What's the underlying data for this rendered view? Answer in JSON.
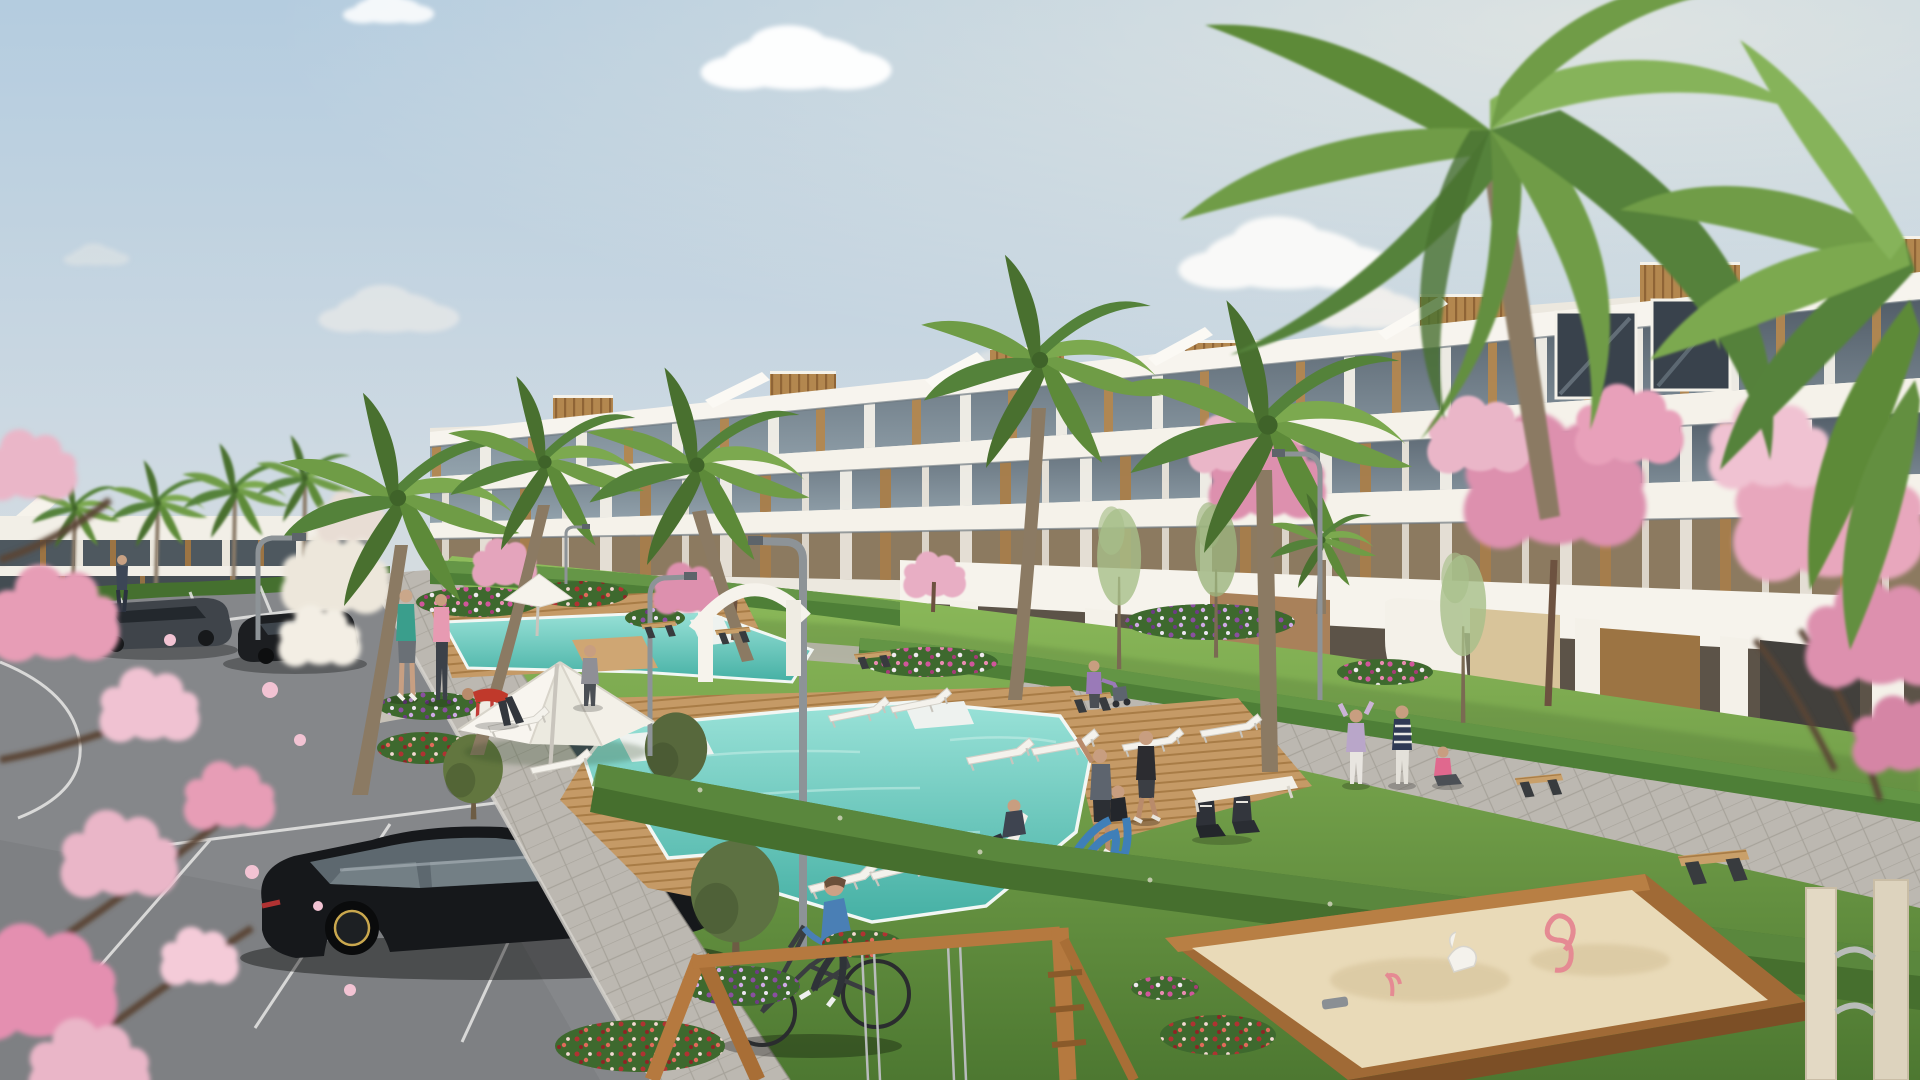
{
  "scene": {
    "description": "Sunny 3D architectural exterior render of a modern white apartment complex with stepped terraces and wood-clad roof boxes, landscaped gardens, angular turquoise pools with timber decking, palm and cherry-blossom trees, a parking lot with dark cars, a cyclist on a paved path, residents walking and exercising on the lawn, and a children's playground with a timber sandbox and swing frame.",
    "time_of_day": "day",
    "weather": "clear with scattered clouds",
    "palette": {
      "sky_top": "#b7cdde",
      "sky_horizon": "#ece7de",
      "cloud": "#ffffff",
      "building_white": "#f5f2ea",
      "building_shadow": "#ddd7cc",
      "glass_dark": "#47505a",
      "wood_accent": "#b3874f",
      "wood_dark": "#7c5a31",
      "pool_light": "#9ae2d8",
      "pool_deep": "#45b0a4",
      "deck_wood": "#c59a66",
      "deck_line": "#a87c46",
      "lawn_light": "#8cba59",
      "lawn_dark": "#4f7a33",
      "hedge": "#4e7f37",
      "asphalt": "#85878a",
      "paver": "#bcb8b1",
      "stall_line": "#e8e8e6",
      "blossom_pink": "#ecb4c8",
      "blossom_deep": "#d585a5",
      "flower_magenta": "#c2427f",
      "flower_purple": "#8a4fa0",
      "flower_red": "#b03232",
      "trunk": "#8b7a63",
      "palm_green": "#6f9c46",
      "palm_green_dark": "#54823a",
      "car_black": "#16181b",
      "car_gray": "#3f444a",
      "car_blue_gray": "#3d4a57",
      "rider_blue": "#4a7fb5",
      "sand": "#e9dab8",
      "umbrella_white": "#f6f3ec"
    },
    "inventory": {
      "buildings": [
        {
          "name": "main apartment block",
          "floors_visible": 4,
          "style": "stepped white terraces, dark glazing, wood slat panels, rooftop wood boxes"
        },
        {
          "name": "background apartment block",
          "floors_visible": 2,
          "style": "white slab with dark glazing bands"
        }
      ],
      "pools": {
        "count": 2,
        "shape": "angular with stepped white platforms",
        "decking": "timber"
      },
      "trees": {
        "palms": 12,
        "cherry_blossoms": 7,
        "olives": 3,
        "slim_green_trees": 3,
        "white_blossom_shrub": 1
      },
      "people": {
        "count": 15,
        "activities": [
          "walking",
          "jogging",
          "stretching",
          "yoga",
          "cycling",
          "sitting",
          "sunbathing",
          "pushing stroller"
        ]
      },
      "vehicles": {
        "parked_cars": 4,
        "bicycles": 1
      },
      "amenities": {
        "sun_loungers": 10,
        "parasols": 2,
        "mini_tent": 1,
        "benches": 6,
        "street_lamps": 5,
        "arch_portal": 1
      },
      "playground": {
        "sandbox": 1,
        "swing_frame": 1,
        "spring_rider_posts": 1,
        "sand_toys": 4
      },
      "parking": {
        "stall_markings": true,
        "painted_curve": true
      }
    }
  }
}
